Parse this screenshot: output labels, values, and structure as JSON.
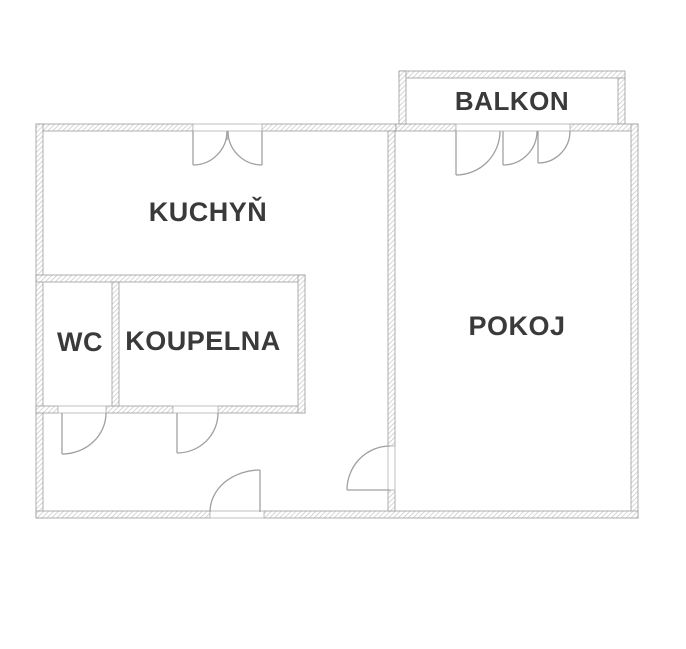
{
  "plan": {
    "type": "floor-plan",
    "rooms": {
      "balkon": {
        "label": "BALKON"
      },
      "kuchyn": {
        "label": "KUCHYŇ"
      },
      "pokoj": {
        "label": "POKOJ"
      },
      "wc": {
        "label": "WC"
      },
      "koupelna": {
        "label": "KOUPELNA"
      }
    },
    "colors": {
      "background": "#ffffff",
      "wall_hatch": "#c6c6c6",
      "wall_border": "#9b9b9b",
      "door_line": "#a0a0a0",
      "label_text": "#3a3a3a"
    }
  }
}
